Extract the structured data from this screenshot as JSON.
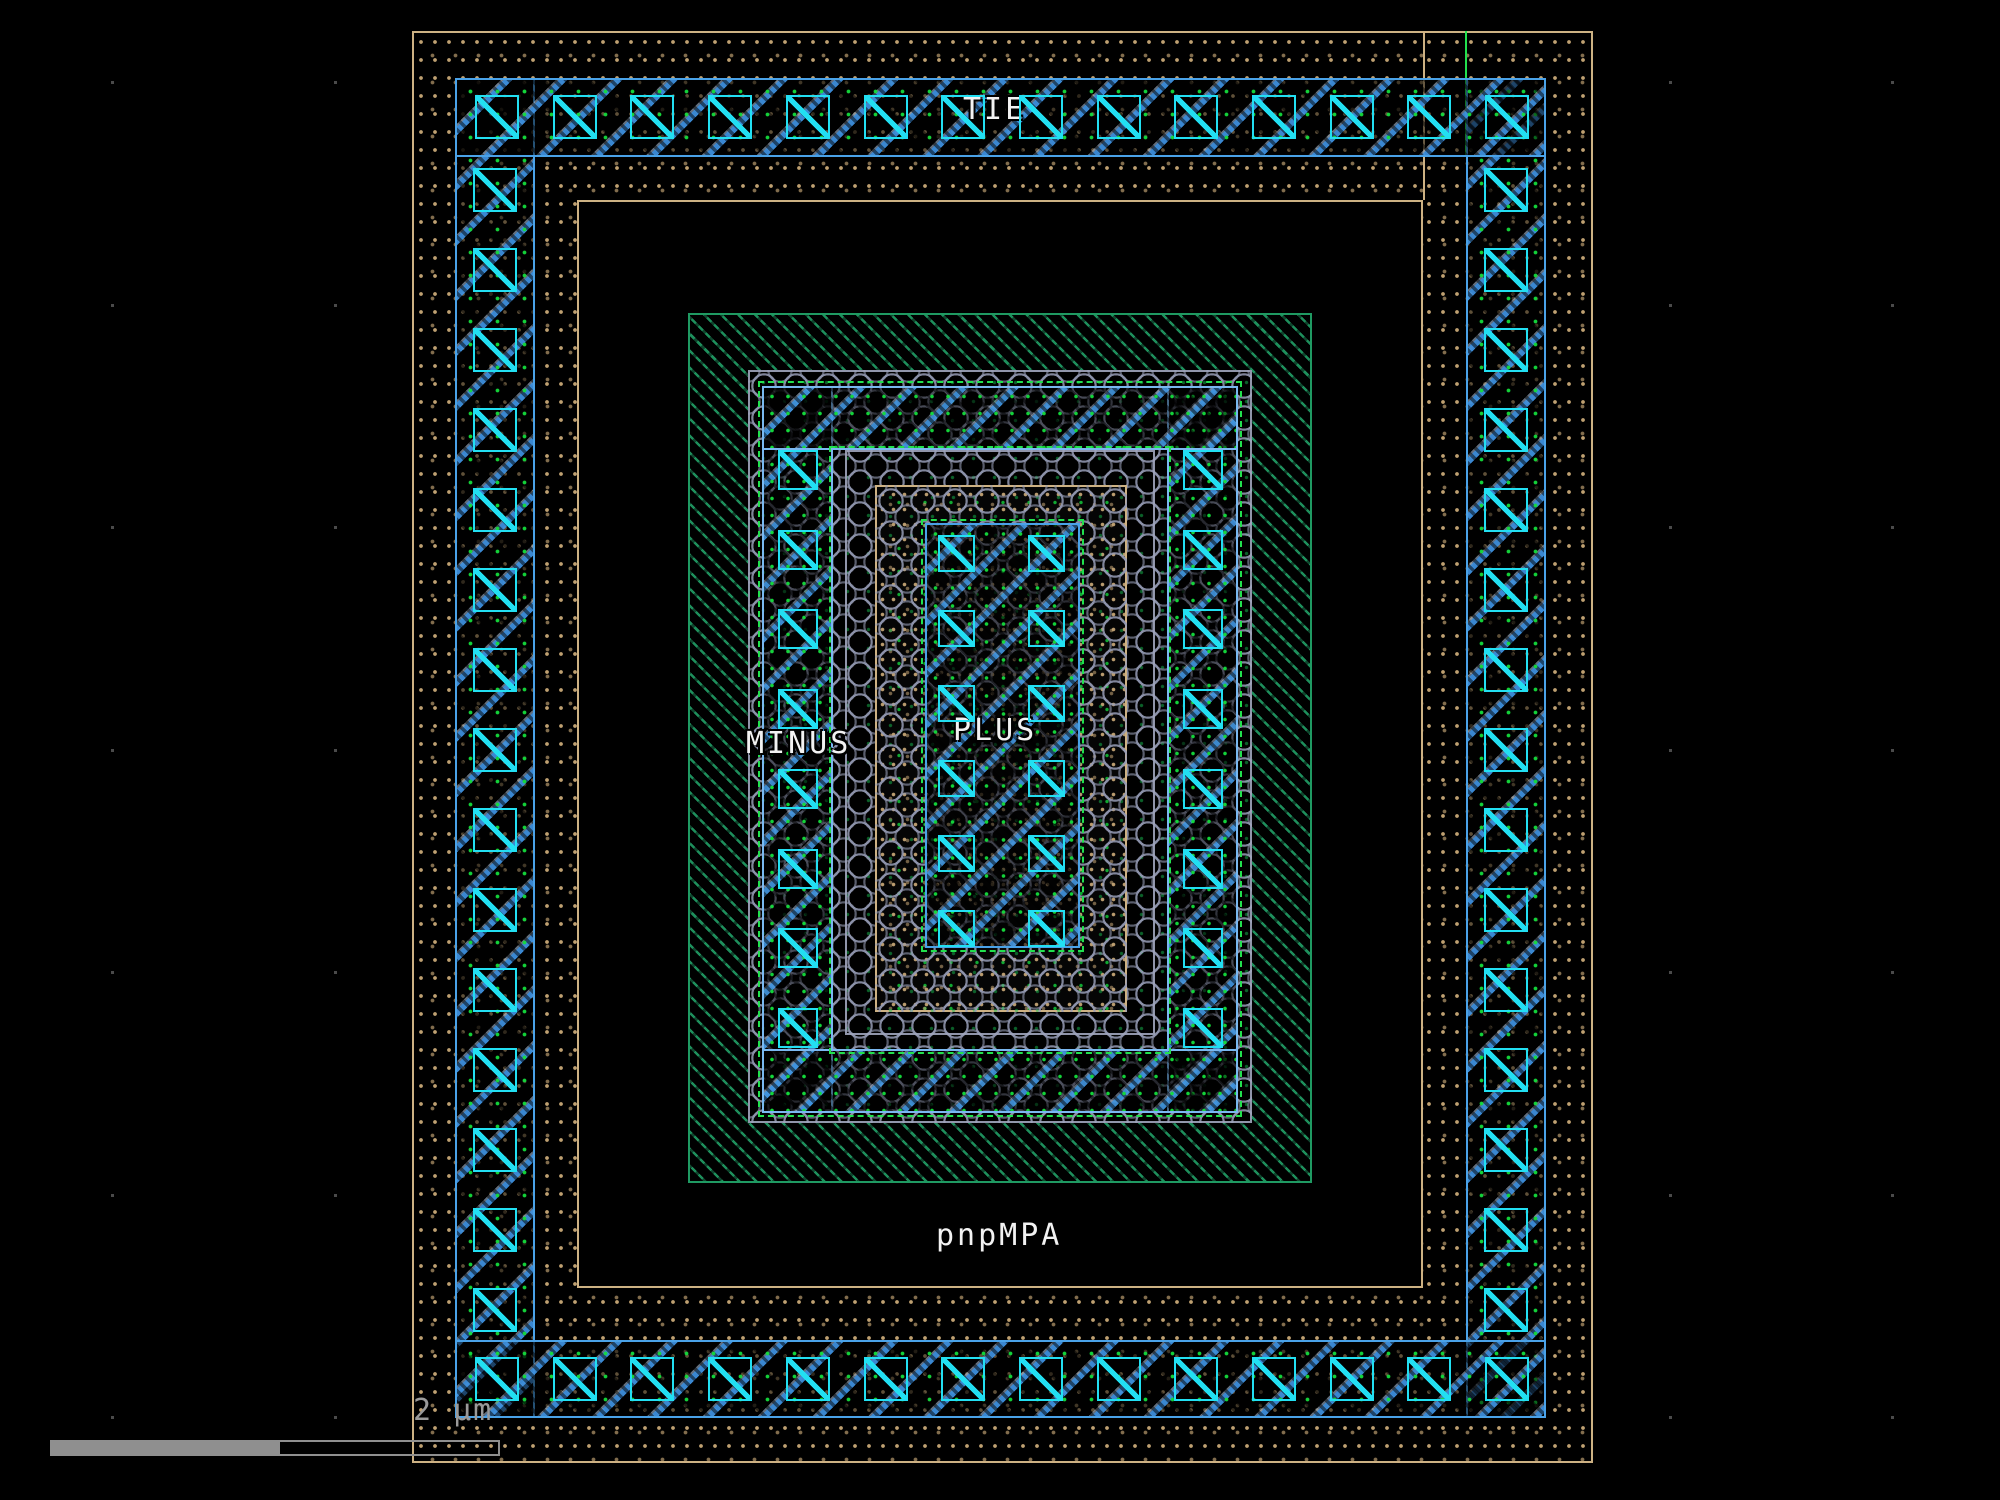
{
  "app": {
    "type": "ic-layout-viewer-canvas"
  },
  "cell": {
    "name": "pnpMPA"
  },
  "net_labels": {
    "tie": "TIE",
    "minus": "MINUS",
    "plus": "PLUS"
  },
  "scale_bar": {
    "label": "2 µm"
  },
  "colors": {
    "substrate_tan": "#cdb183",
    "metal_blue": "#4aa2e8",
    "contact_cyan": "#22dff2",
    "well_green": "#1f9a62",
    "dash_green": "#22e04e",
    "via_gray": "#9097ad",
    "text_white": "#f2f2f2",
    "scalebar_gray": "#8f8f8f",
    "background": "#000000"
  },
  "contact_counts": {
    "tie_top": 14,
    "tie_bottom": 14,
    "tie_left": 15,
    "tie_right": 15,
    "minus_per_leg": 8,
    "plus_rows": 6,
    "plus_cols": 2
  },
  "grid": {
    "spacing_px": 222.5
  }
}
